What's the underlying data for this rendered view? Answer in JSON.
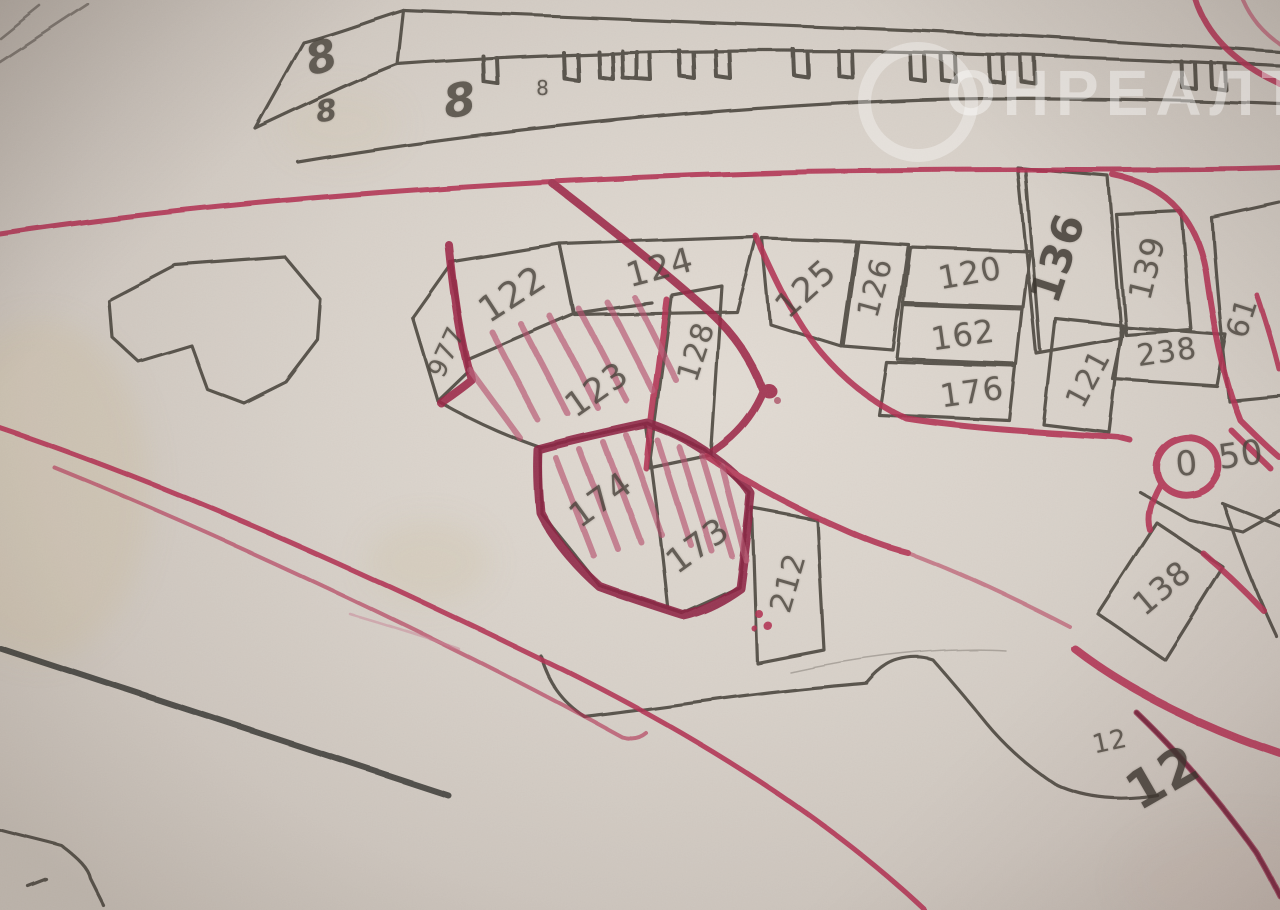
{
  "photo": {
    "description": "Photograph of a printed cadastral plan annotated by hand with red marker",
    "watermark": {
      "text": "ОНРЕАЛТ"
    },
    "colors": {
      "paper": "#d8d1c9",
      "pencil": "#433c35",
      "marker_red": "#b23152",
      "marker_dark_red": "#8e2342",
      "marker_pink": "#d98ba0"
    }
  },
  "map": {
    "plot_labels": [
      {
        "plot": "977",
        "text": "977"
      },
      {
        "plot": "122",
        "text": "122"
      },
      {
        "plot": "124",
        "text": "124"
      },
      {
        "plot": "123",
        "text": "123"
      },
      {
        "plot": "128",
        "text": "128"
      },
      {
        "plot": "125",
        "text": "125"
      },
      {
        "plot": "126",
        "text": "126"
      },
      {
        "plot": "120",
        "text": "120"
      },
      {
        "plot": "162",
        "text": "162"
      },
      {
        "plot": "176",
        "text": "176"
      },
      {
        "plot": "121",
        "text": "121"
      },
      {
        "plot": "238",
        "text": "238"
      },
      {
        "plot": "136",
        "text": "136"
      },
      {
        "plot": "139",
        "text": "139"
      },
      {
        "plot": "61",
        "text": "61"
      },
      {
        "plot": "174",
        "text": "174"
      },
      {
        "plot": "173",
        "text": "173"
      },
      {
        "plot": "212",
        "text": "212"
      },
      {
        "plot": "138",
        "text": "138"
      }
    ],
    "building_labels": [
      {
        "id": "8-a",
        "text": "8"
      },
      {
        "id": "8-b",
        "text": "8"
      },
      {
        "id": "8-c",
        "text": "8"
      },
      {
        "id": "8-d",
        "text": "8"
      }
    ],
    "misc_labels": [
      {
        "id": "block-12-small",
        "text": "12"
      },
      {
        "id": "block-12-large",
        "text": "12"
      },
      {
        "id": "dim-0",
        "text": "0"
      },
      {
        "id": "dim-50",
        "text": "50"
      }
    ]
  }
}
